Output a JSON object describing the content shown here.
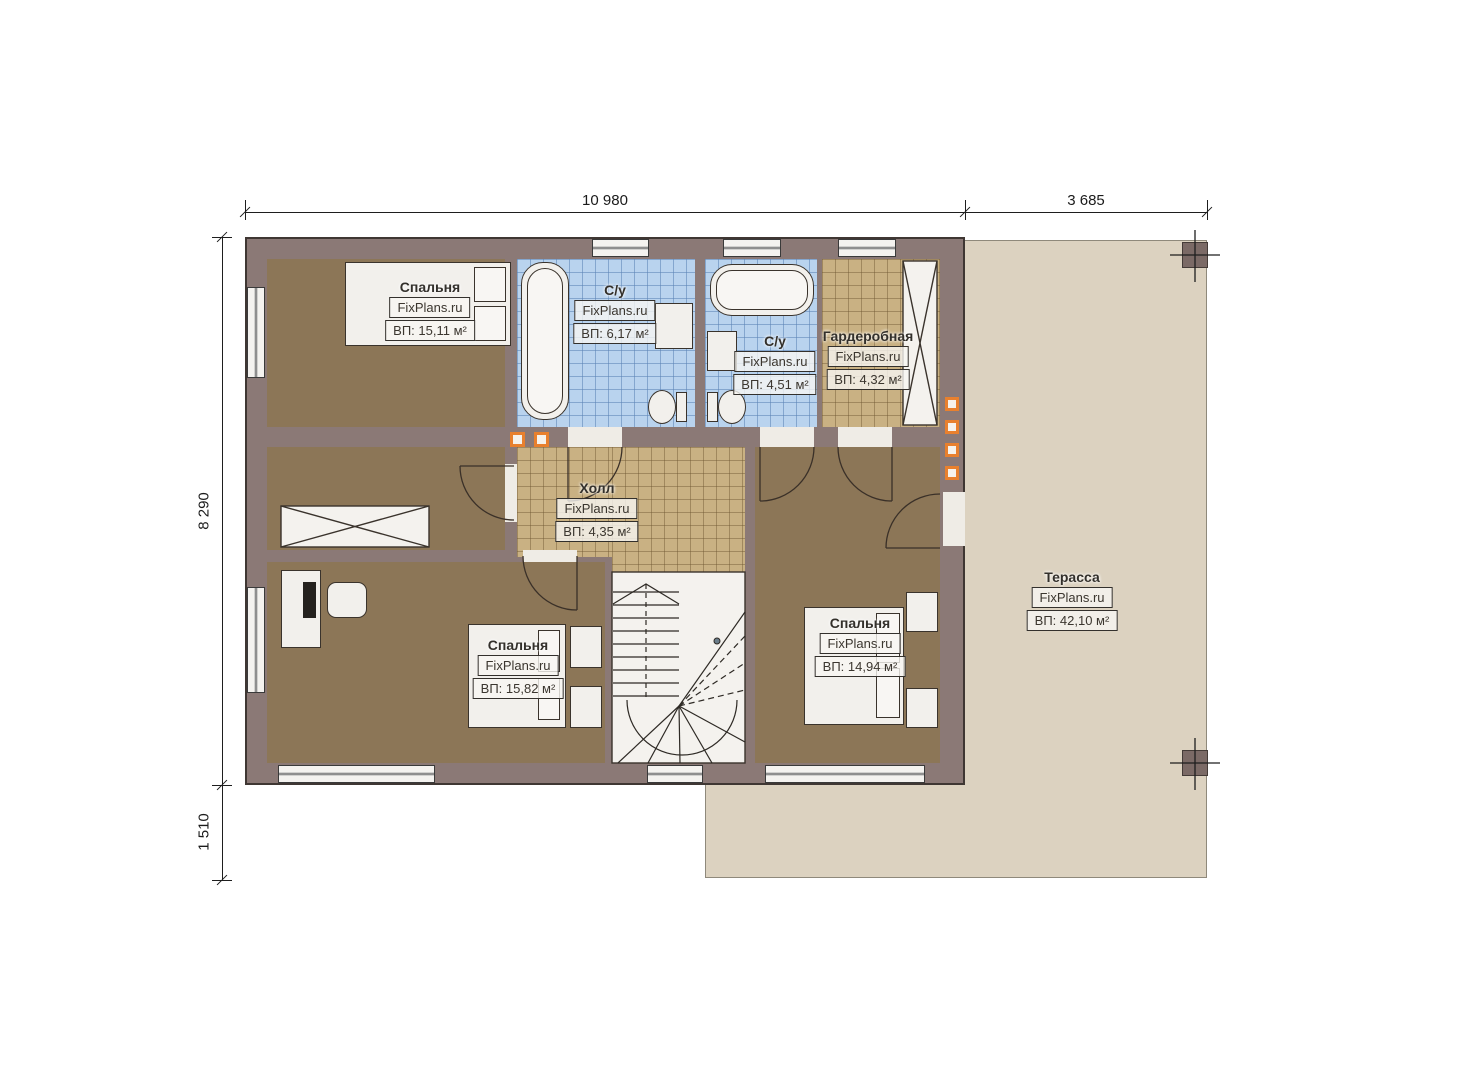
{
  "plan": {
    "type": "floor-plan-second-level",
    "brand_watermark": "FixPlans.ru"
  },
  "dimensions": {
    "top_house_width": "10 980",
    "top_terrace_width": "3 685",
    "left_house_height": "8 290",
    "left_terrace_height": "1 510"
  },
  "rooms": {
    "bedroom_top_left": {
      "name": "Спальня",
      "watermark": "FixPlans.ru",
      "area": "ВП: 15,11 м²"
    },
    "bathroom_main": {
      "name": "С/у",
      "watermark": "FixPlans.ru",
      "area": "ВП: 6,17 м²"
    },
    "bathroom_second": {
      "name": "С/у",
      "watermark": "FixPlans.ru",
      "area": "ВП: 4,51 м²"
    },
    "wardrobe": {
      "name": "Гардеробная",
      "watermark": "FixPlans.ru",
      "area": "ВП: 4,32 м²"
    },
    "hall": {
      "name": "Холл",
      "watermark": "FixPlans.ru",
      "area": "ВП: 4,35 м²"
    },
    "bedroom_bottom_left": {
      "name": "Спальня",
      "watermark": "FixPlans.ru",
      "area": "ВП: 15,82 м²"
    },
    "bedroom_bottom_right": {
      "name": "Спальня",
      "watermark": "FixPlans.ru",
      "area": "ВП: 14,94 м²"
    },
    "terrace": {
      "name": "Терасса",
      "watermark": "FixPlans.ru",
      "area": "ВП: 42,10 м²"
    }
  },
  "colors": {
    "wall": "#8b7976",
    "bedroom_floor": "#8c7657",
    "bathroom_tile": "#b9d3ee",
    "hall_tile": "#c9b183",
    "terrace": "#dcd2c0",
    "column_accent": "#e8802e"
  }
}
